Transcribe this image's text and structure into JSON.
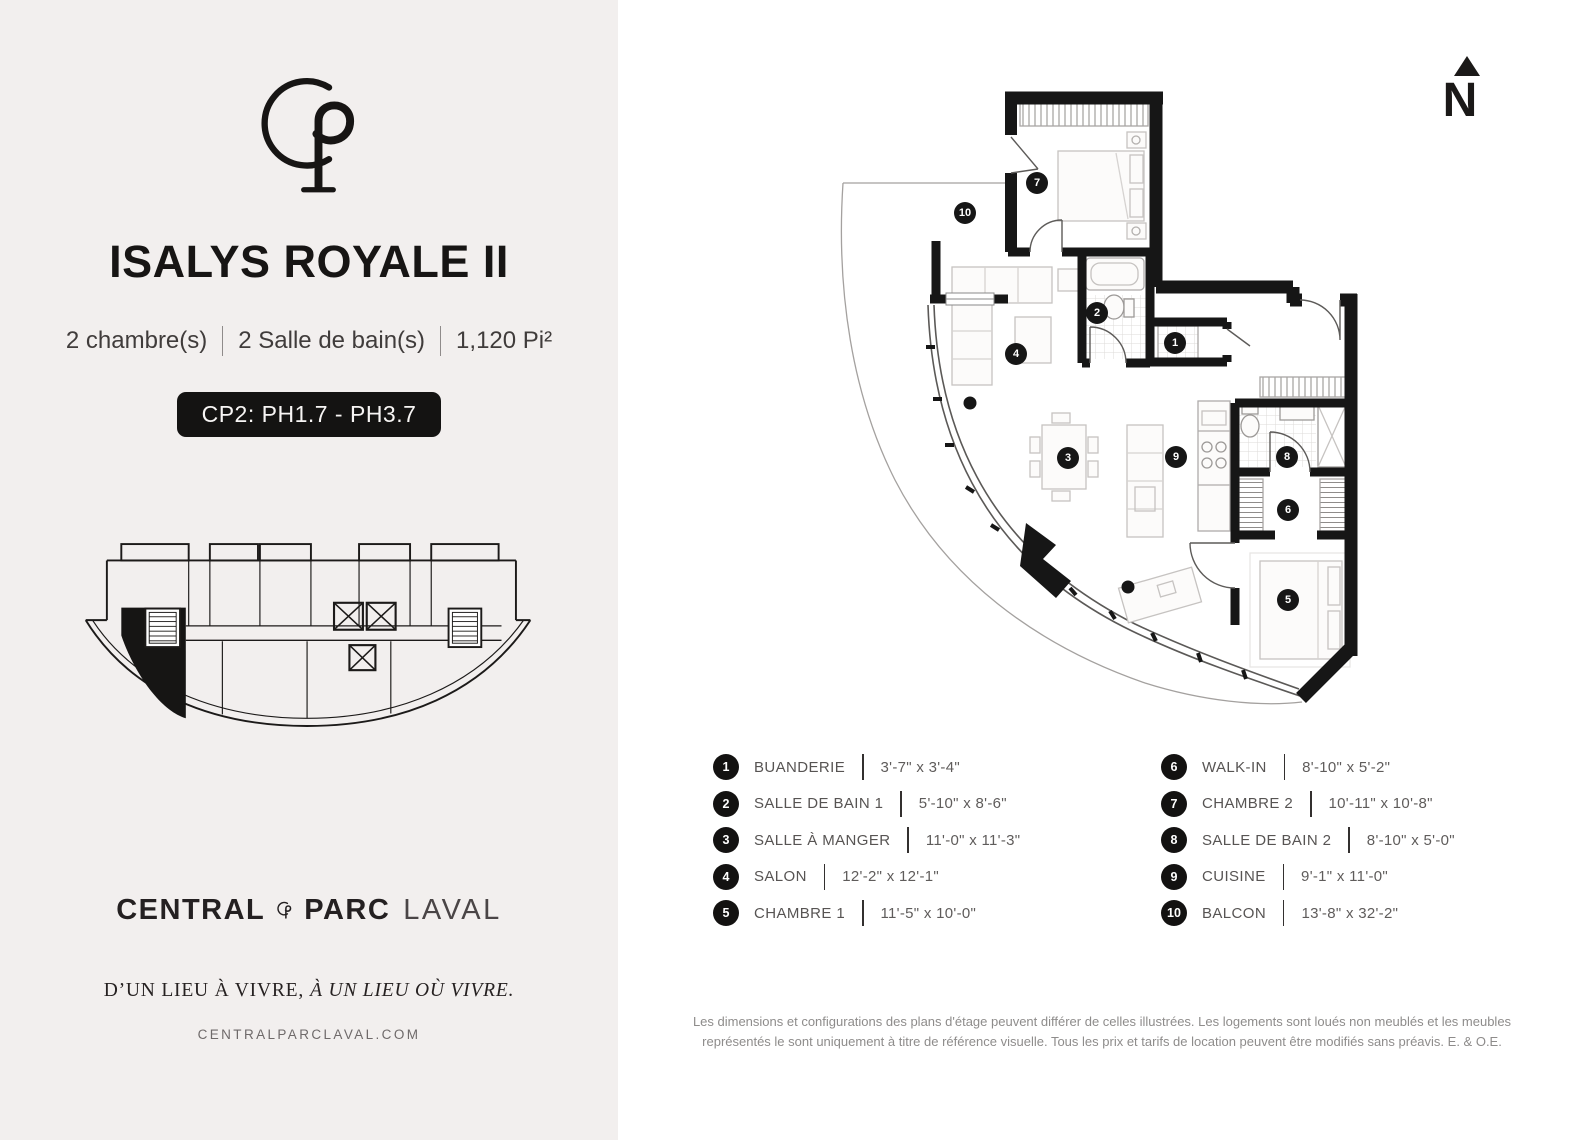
{
  "left_panel": {
    "title": "ISALYS ROYALE II",
    "specs": [
      "2 chambre(s)",
      "2 Salle de bain(s)",
      "1,120 Pi²"
    ],
    "badge": "CP2: PH1.7 - PH3.7",
    "brand": {
      "central": "CENTRAL",
      "parc": "PARC",
      "laval": "LAVAL"
    },
    "tagline": {
      "regular": "D’UN LIEU À VIVRE,",
      "italic": "À UN LIEU OÙ VIVRE."
    },
    "website": "CENTRALPARCLAVAL.COM"
  },
  "floor_plan": {
    "north_label": "N",
    "markers": [
      {
        "label": "1"
      },
      {
        "label": "2"
      },
      {
        "label": "3"
      },
      {
        "label": "4"
      },
      {
        "label": "5"
      },
      {
        "label": "6"
      },
      {
        "label": "7"
      },
      {
        "label": "8"
      },
      {
        "label": "9"
      },
      {
        "label": "10"
      }
    ]
  },
  "legend": {
    "col1": [
      {
        "num": "1",
        "name": "BUANDERIE",
        "dims": "3'-7\" x 3'-4\""
      },
      {
        "num": "2",
        "name": "SALLE DE BAIN 1",
        "dims": "5'-10\" x 8'-6\""
      },
      {
        "num": "3",
        "name": "SALLE À MANGER",
        "dims": "11'-0\" x 11'-3\""
      },
      {
        "num": "4",
        "name": "SALON",
        "dims": "12'-2\" x 12'-1\""
      },
      {
        "num": "5",
        "name": "CHAMBRE 1",
        "dims": "11'-5\" x 10'-0\""
      }
    ],
    "col2": [
      {
        "num": "6",
        "name": "WALK-IN",
        "dims": "8'-10\" x 5'-2\""
      },
      {
        "num": "7",
        "name": "CHAMBRE 2",
        "dims": "10'-11\" x 10'-8\""
      },
      {
        "num": "8",
        "name": "SALLE DE BAIN 2",
        "dims": "8'-10\" x 5'-0\""
      },
      {
        "num": "9",
        "name": "CUISINE",
        "dims": "9'-1\" x 11'-0\""
      },
      {
        "num": "10",
        "name": "BALCON",
        "dims": "13'-8\" x 32'-2\""
      }
    ]
  },
  "disclaimer": "Les dimensions et configurations des plans d'étage peuvent différer de celles illustrées. Les logements sont loués non meublés et les meubles représentés le sont uniquement à titre de référence visuelle. Tous les prix et tarifs de location peuvent être modifiés sans préavis. E. & O.E."
}
